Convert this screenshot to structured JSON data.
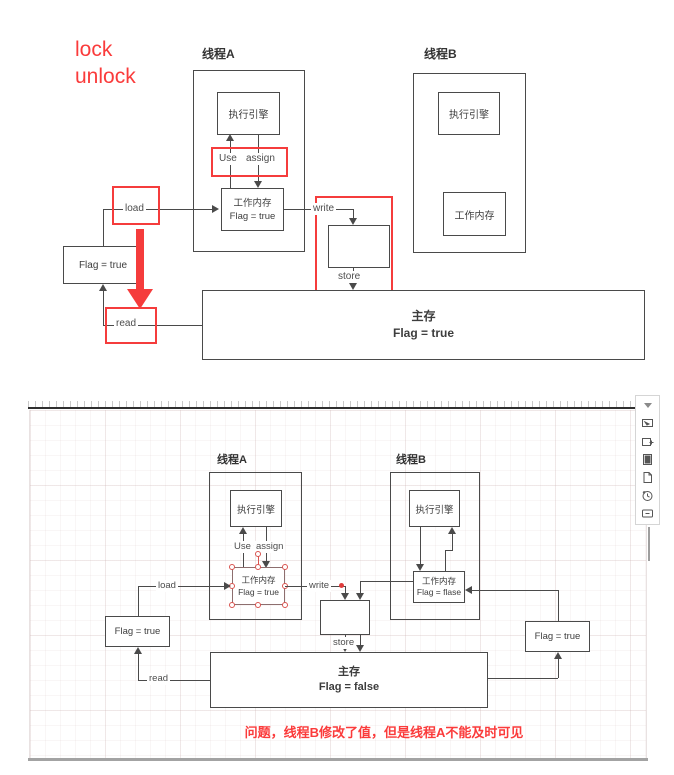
{
  "colors": {
    "annotation_red": "#fa3b3b",
    "line_gray": "#4a4a4a",
    "selection_red": "#d9534f"
  },
  "top": {
    "annotation": {
      "line1": "lock",
      "line2": "unlock"
    },
    "thread_a": {
      "title": "线程A",
      "engine": "执行引擎",
      "use": "Use",
      "assign": "assign",
      "wm_title": "工作内存",
      "wm_value": "Flag = true"
    },
    "thread_b": {
      "title": "线程B",
      "engine": "执行引擎",
      "wm_title": "工作内存"
    },
    "labels": {
      "load": "load",
      "read": "read",
      "write": "write",
      "store": "store"
    },
    "flag_box": "Flag = true",
    "main_memory": {
      "title": "主存",
      "value": "Flag = true"
    }
  },
  "bottom": {
    "thread_a": {
      "title": "线程A",
      "engine": "执行引擎",
      "use": "Use",
      "assign": "assign",
      "wm_title": "工作内存",
      "wm_value": "Flag = true"
    },
    "thread_b": {
      "title": "线程B",
      "engine": "执行引擎",
      "wm_title": "工作内存",
      "wm_value": "Flag = flase"
    },
    "labels": {
      "load": "load",
      "read": "read",
      "write": "write",
      "store": "store"
    },
    "left_flag": "Flag = true",
    "right_flag": "Flag = true",
    "main_memory": {
      "title": "主存",
      "value": "Flag = false"
    },
    "problem_text": "问题，线程B修改了值，但是线程A不能及时可见"
  },
  "toolbar": {
    "icons": [
      "collapse-caret",
      "pointer-flag",
      "add-frame",
      "notebook",
      "new-page",
      "history",
      "comment"
    ]
  }
}
